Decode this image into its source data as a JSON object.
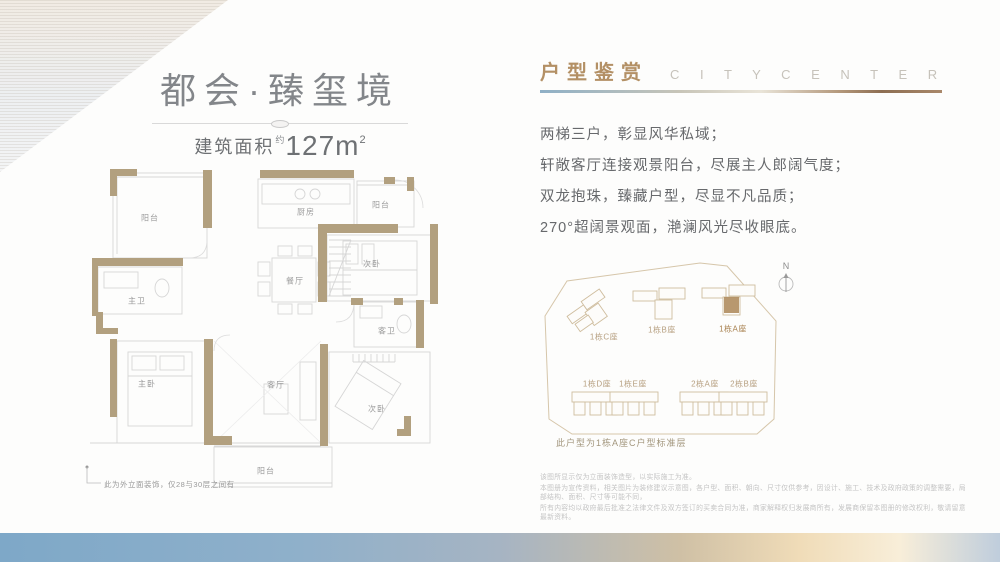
{
  "left": {
    "title": "都会·臻玺境",
    "area": {
      "label": "建筑面积",
      "approx": "约",
      "value": "127",
      "unit": "m",
      "exp": "2"
    },
    "floorplan": {
      "rooms": [
        {
          "label": "阳台"
        },
        {
          "label": "厨房"
        },
        {
          "label": "阳台"
        },
        {
          "label": "次卧"
        },
        {
          "label": "餐厅"
        },
        {
          "label": "主卫"
        },
        {
          "label": "客卫"
        },
        {
          "label": "主卧"
        },
        {
          "label": "客厅"
        },
        {
          "label": "次卧"
        },
        {
          "label": "阳台"
        }
      ],
      "footnote": "此为外立面装饰，仅28与30层之间有"
    }
  },
  "right": {
    "header": {
      "cn": "户型鉴赏",
      "en": "C I T Y   C E N T E R"
    },
    "desc": [
      "两梯三户，彰显风华私域；",
      "轩敞客厅连接观景阳台，尽展主人郎阔气度；",
      "双龙抱珠，臻藏户型，尽显不凡品质；",
      "270°超阔景观面，滟澜风光尽收眼底。"
    ],
    "siteplan": {
      "north": "N",
      "buildings": [
        {
          "label": "1栋C座"
        },
        {
          "label": "1栋B座"
        },
        {
          "label": "1栋A座",
          "highlight": true
        },
        {
          "label": "1栋D座"
        },
        {
          "label": "1栋E座"
        },
        {
          "label": "2栋A座"
        },
        {
          "label": "2栋B座"
        }
      ],
      "caption": "此户型为1栋A座C户型标准层"
    },
    "disclaimer": [
      "该图所显示仅为立面装饰造型，以实际施工为准。",
      "本图册为宣传资料，相关图片为装修建议示意图，各户型、面积、朝向、尺寸仅供参考，因设计、施工、技术及政府政策的调整需要，局部结构、面积、尺寸等可能不同，",
      "所有内容均以政府最后批准之法律文件及双方签订的买卖合同为准，商家解释权归发展商所有，发展商保留本图册的修改权利，敬请留意最新资料。"
    ]
  },
  "colors": {
    "accent_gold": "#b39065",
    "wall_tan": "#b2a07f",
    "siteplan_line": "#d6c6aa",
    "band_blue": "#7ea8c8",
    "band_cream": "#f8eed9",
    "title_gray": "#83868a"
  }
}
